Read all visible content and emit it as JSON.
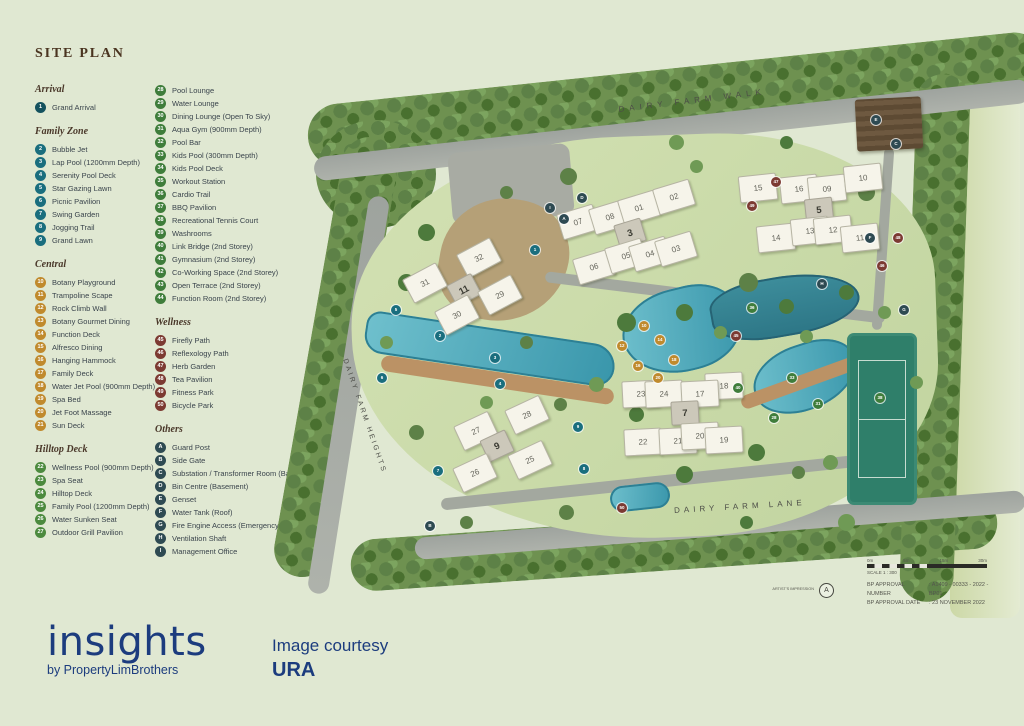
{
  "title": "SITE PLAN",
  "legend": {
    "column1": [
      {
        "heading": "Arrival",
        "color": "#14525e",
        "items": [
          {
            "n": "1",
            "label": "Grand Arrival"
          }
        ]
      },
      {
        "heading": "Family Zone",
        "color": "#1a6e7e",
        "items": [
          {
            "n": "2",
            "label": "Bubble Jet"
          },
          {
            "n": "3",
            "label": "Lap Pool (1200mm Depth)"
          },
          {
            "n": "4",
            "label": "Serenity Pool Deck"
          },
          {
            "n": "5",
            "label": "Star Gazing Lawn"
          },
          {
            "n": "6",
            "label": "Picnic Pavilion"
          },
          {
            "n": "7",
            "label": "Swing Garden"
          },
          {
            "n": "8",
            "label": "Jogging Trail"
          },
          {
            "n": "9",
            "label": "Grand Lawn"
          }
        ]
      },
      {
        "heading": "Central",
        "color": "#c08a2d",
        "items": [
          {
            "n": "10",
            "label": "Botany Playground"
          },
          {
            "n": "11",
            "label": "Trampoline Scape"
          },
          {
            "n": "12",
            "label": "Rock Climb Wall"
          },
          {
            "n": "13",
            "label": "Botany Gourmet Dining"
          },
          {
            "n": "14",
            "label": "Function Deck"
          },
          {
            "n": "15",
            "label": "Alfresco Dining"
          },
          {
            "n": "16",
            "label": "Hanging Hammock"
          },
          {
            "n": "17",
            "label": "Family Deck"
          },
          {
            "n": "18",
            "label": "Water Jet Pool (900mm Depth)"
          },
          {
            "n": "19",
            "label": "Spa Bed"
          },
          {
            "n": "20",
            "label": "Jet Foot Massage"
          },
          {
            "n": "21",
            "label": "Sun Deck"
          }
        ]
      },
      {
        "heading": "Hilltop Deck",
        "color": "#4c8a3e",
        "items": [
          {
            "n": "22",
            "label": "Wellness Pool (900mm Depth)"
          },
          {
            "n": "23",
            "label": "Spa Seat"
          },
          {
            "n": "24",
            "label": "Hilltop Deck"
          },
          {
            "n": "25",
            "label": "Family Pool (1200mm Depth)"
          },
          {
            "n": "26",
            "label": "Water Sunken Seat"
          },
          {
            "n": "27",
            "label": "Outdoor Grill Pavilion"
          }
        ]
      }
    ],
    "column2": [
      {
        "heading": "",
        "color": "#3f7d3b",
        "items": [
          {
            "n": "28",
            "label": "Pool Lounge"
          },
          {
            "n": "29",
            "label": "Water Lounge"
          },
          {
            "n": "30",
            "label": "Dining Lounge (Open To Sky)"
          },
          {
            "n": "31",
            "label": "Aqua Gym (900mm Depth)"
          },
          {
            "n": "32",
            "label": "Pool Bar"
          },
          {
            "n": "33",
            "label": "Kids Pool (300mm Depth)"
          },
          {
            "n": "34",
            "label": "Kids Pool Deck"
          },
          {
            "n": "35",
            "label": "Workout Station"
          },
          {
            "n": "36",
            "label": "Cardio Trail"
          },
          {
            "n": "37",
            "label": "BBQ Pavilion"
          },
          {
            "n": "38",
            "label": "Recreational Tennis Court"
          },
          {
            "n": "39",
            "label": "Washrooms"
          },
          {
            "n": "40",
            "label": "Link Bridge (2nd Storey)"
          },
          {
            "n": "41",
            "label": "Gymnasium (2nd Storey)"
          },
          {
            "n": "42",
            "label": "Co-Working Space (2nd Storey)"
          },
          {
            "n": "43",
            "label": "Open Terrace (2nd Storey)"
          },
          {
            "n": "44",
            "label": "Function Room (2nd Storey)"
          }
        ]
      },
      {
        "heading": "Wellness",
        "color": "#7c3a32",
        "items": [
          {
            "n": "45",
            "label": "Firefly Path"
          },
          {
            "n": "46",
            "label": "Reflexology Path"
          },
          {
            "n": "47",
            "label": "Herb Garden"
          },
          {
            "n": "48",
            "label": "Tea Pavilion"
          },
          {
            "n": "49",
            "label": "Fitness Park"
          },
          {
            "n": "50",
            "label": "Bicycle Park"
          }
        ]
      },
      {
        "heading": "Others",
        "color": "#2e4a52",
        "items": [
          {
            "n": "A",
            "label": "Guard Post"
          },
          {
            "n": "B",
            "label": "Side Gate"
          },
          {
            "n": "C",
            "label": "Substation / Transformer Room (Basement)"
          },
          {
            "n": "D",
            "label": "Bin Centre (Basement)"
          },
          {
            "n": "E",
            "label": "Genset"
          },
          {
            "n": "F",
            "label": "Water Tank (Roof)"
          },
          {
            "n": "G",
            "label": "Fire Engine Access (Emergency Only)"
          },
          {
            "n": "H",
            "label": "Ventilation Shaft"
          },
          {
            "n": "I",
            "label": "Management Office"
          }
        ]
      }
    ]
  },
  "map": {
    "roads": {
      "walk": "DAIRY FARM WALK",
      "heights": "DAIRY FARM HEIGHTS",
      "lane": "DAIRY FARM LANE"
    },
    "buildings": [
      {
        "label": "31",
        "x": 103,
        "y": 205,
        "r": -28
      },
      {
        "label": "32",
        "x": 157,
        "y": 180,
        "r": -28
      },
      {
        "label": "11",
        "x": 142,
        "y": 212,
        "r": -28,
        "bold": true
      },
      {
        "label": "29",
        "x": 178,
        "y": 217,
        "r": -28
      },
      {
        "label": "30",
        "x": 135,
        "y": 237,
        "r": -28
      },
      {
        "label": "07",
        "x": 256,
        "y": 144,
        "r": -17
      },
      {
        "label": "08",
        "x": 288,
        "y": 139,
        "r": -17
      },
      {
        "label": "01",
        "x": 317,
        "y": 130,
        "r": -17
      },
      {
        "label": "02",
        "x": 352,
        "y": 119,
        "r": -17
      },
      {
        "label": "3",
        "x": 308,
        "y": 155,
        "r": -17,
        "bold": true
      },
      {
        "label": "06",
        "x": 272,
        "y": 189,
        "r": -17
      },
      {
        "label": "05",
        "x": 304,
        "y": 178,
        "r": -17
      },
      {
        "label": "04",
        "x": 328,
        "y": 176,
        "r": -17
      },
      {
        "label": "03",
        "x": 354,
        "y": 171,
        "r": -17
      },
      {
        "label": "15",
        "x": 436,
        "y": 110,
        "r": -6
      },
      {
        "label": "16",
        "x": 477,
        "y": 111,
        "r": -6
      },
      {
        "label": "09",
        "x": 505,
        "y": 111,
        "r": -6
      },
      {
        "label": "10",
        "x": 541,
        "y": 100,
        "r": -6
      },
      {
        "label": "5",
        "x": 497,
        "y": 132,
        "r": -6,
        "bold": true
      },
      {
        "label": "14",
        "x": 454,
        "y": 160,
        "r": -6
      },
      {
        "label": "13",
        "x": 488,
        "y": 153,
        "r": -6
      },
      {
        "label": "12",
        "x": 511,
        "y": 152,
        "r": -6
      },
      {
        "label": "11",
        "x": 538,
        "y": 160,
        "r": -6
      },
      {
        "label": "18",
        "x": 402,
        "y": 308,
        "r": -3
      },
      {
        "label": "23",
        "x": 319,
        "y": 316,
        "r": -3
      },
      {
        "label": "24",
        "x": 342,
        "y": 316,
        "r": -3
      },
      {
        "label": "17",
        "x": 378,
        "y": 316,
        "r": -3
      },
      {
        "label": "7",
        "x": 363,
        "y": 335,
        "r": -3,
        "bold": true
      },
      {
        "label": "22",
        "x": 321,
        "y": 364,
        "r": -3
      },
      {
        "label": "21",
        "x": 356,
        "y": 363,
        "r": -3
      },
      {
        "label": "20",
        "x": 378,
        "y": 358,
        "r": -3
      },
      {
        "label": "19",
        "x": 402,
        "y": 362,
        "r": -3
      },
      {
        "label": "27",
        "x": 154,
        "y": 353,
        "r": -25
      },
      {
        "label": "28",
        "x": 205,
        "y": 337,
        "r": -25
      },
      {
        "label": "9",
        "x": 175,
        "y": 368,
        "r": -25,
        "bold": true
      },
      {
        "label": "25",
        "x": 208,
        "y": 382,
        "r": -25
      },
      {
        "label": "26",
        "x": 153,
        "y": 395,
        "r": -25
      }
    ],
    "markers": [
      {
        "label": "1",
        "x": 213,
        "y": 172,
        "c": "teal"
      },
      {
        "label": "2",
        "x": 118,
        "y": 258,
        "c": "teal"
      },
      {
        "label": "3",
        "x": 173,
        "y": 280,
        "c": "teal"
      },
      {
        "label": "4",
        "x": 178,
        "y": 306,
        "c": "teal"
      },
      {
        "label": "5",
        "x": 74,
        "y": 232,
        "c": "teal"
      },
      {
        "label": "6",
        "x": 60,
        "y": 300,
        "c": "teal"
      },
      {
        "label": "7",
        "x": 116,
        "y": 393,
        "c": "teal"
      },
      {
        "label": "8",
        "x": 262,
        "y": 391,
        "c": "teal"
      },
      {
        "label": "9",
        "x": 256,
        "y": 349,
        "c": "teal"
      },
      {
        "label": "10",
        "x": 322,
        "y": 248,
        "c": "gold"
      },
      {
        "label": "12",
        "x": 300,
        "y": 268,
        "c": "gold"
      },
      {
        "label": "14",
        "x": 338,
        "y": 262,
        "c": "gold"
      },
      {
        "label": "16",
        "x": 316,
        "y": 288,
        "c": "gold"
      },
      {
        "label": "18",
        "x": 352,
        "y": 282,
        "c": "gold"
      },
      {
        "label": "20",
        "x": 336,
        "y": 300,
        "c": "gold"
      },
      {
        "label": "28",
        "x": 452,
        "y": 340,
        "c": "green"
      },
      {
        "label": "31",
        "x": 496,
        "y": 326,
        "c": "green"
      },
      {
        "label": "33",
        "x": 470,
        "y": 300,
        "c": "green"
      },
      {
        "label": "36",
        "x": 430,
        "y": 230,
        "c": "green"
      },
      {
        "label": "38",
        "x": 558,
        "y": 320,
        "c": "green"
      },
      {
        "label": "40",
        "x": 416,
        "y": 310,
        "c": "green"
      },
      {
        "label": "45",
        "x": 414,
        "y": 258,
        "c": "maroon"
      },
      {
        "label": "46",
        "x": 560,
        "y": 188,
        "c": "maroon"
      },
      {
        "label": "47",
        "x": 454,
        "y": 104,
        "c": "maroon"
      },
      {
        "label": "48",
        "x": 576,
        "y": 160,
        "c": "maroon"
      },
      {
        "label": "49",
        "x": 430,
        "y": 128,
        "c": "maroon"
      },
      {
        "label": "50",
        "x": 300,
        "y": 430,
        "c": "maroon"
      },
      {
        "label": "A",
        "x": 242,
        "y": 141,
        "c": "slate"
      },
      {
        "label": "B",
        "x": 108,
        "y": 448,
        "c": "slate"
      },
      {
        "label": "C",
        "x": 574,
        "y": 66,
        "c": "slate"
      },
      {
        "label": "D",
        "x": 260,
        "y": 120,
        "c": "slate"
      },
      {
        "label": "E",
        "x": 554,
        "y": 42,
        "c": "slate"
      },
      {
        "label": "F",
        "x": 548,
        "y": 160,
        "c": "slate"
      },
      {
        "label": "G",
        "x": 582,
        "y": 232,
        "c": "slate"
      },
      {
        "label": "H",
        "x": 500,
        "y": 206,
        "c": "slate"
      },
      {
        "label": "I",
        "x": 228,
        "y": 130,
        "c": "slate"
      }
    ],
    "scale": {
      "ticks": [
        "0m",
        "5m",
        "15m",
        "30m"
      ],
      "scale_text": "SCALE 1 : 300",
      "artist_label": "ARTIST'S IMPRESSION",
      "north_letter": "A",
      "rows": [
        {
          "label": "BP APPROVAL NUMBER",
          "value": ": A1409 - 00333 - 2022 - BP01"
        },
        {
          "label": "BP APPROVAL DATE",
          "value": ": 23 NOVEMBER 2022"
        }
      ]
    }
  },
  "footer": {
    "logo": "insights",
    "logo_sub": "by PropertyLimBrothers",
    "courtesy_line1": "Image courtesy",
    "courtesy_line2": "URA"
  },
  "colors": {
    "background": "#e0e8d2",
    "navy": "#1c3c7e",
    "teal": "#1a6e7e",
    "gold": "#c08a2d",
    "green": "#3f7d3b",
    "maroon": "#7c3a32",
    "slate": "#2e4a52",
    "pool": "#3996ab",
    "tennis": "#2f7f6a"
  }
}
